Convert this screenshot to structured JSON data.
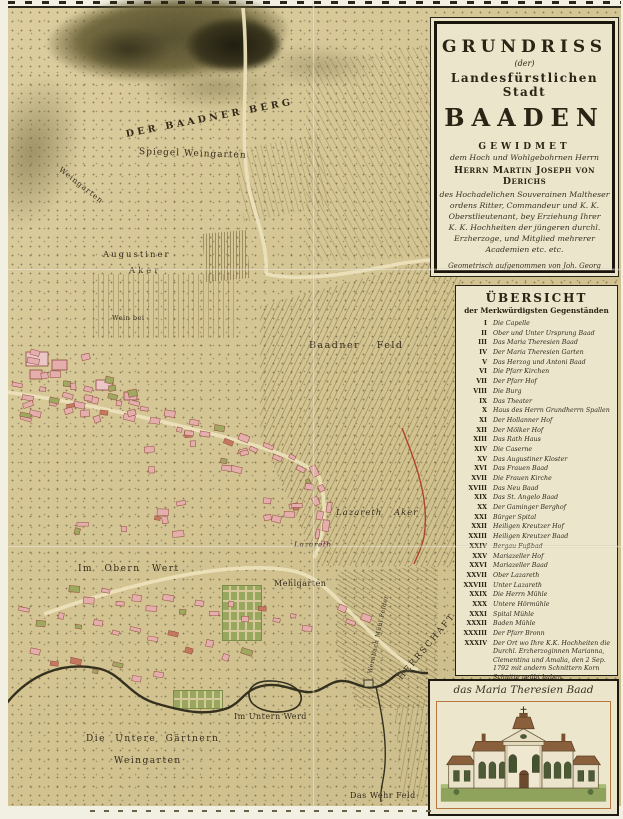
{
  "colors": {
    "paper": "#d5c797",
    "panel_cream": "#ebe5cc",
    "ink": "#2b2414",
    "building_pink": "#e4aeac",
    "garden_green": "#98a75e",
    "river": "#33301e",
    "frame_orange": "#b5773f",
    "boundary_red": "#b0442a"
  },
  "title_panel": {
    "grundriss": "GRUNDRISS",
    "der": "(der)",
    "stadt": "Landesfürstlichen Stadt",
    "baaden": "BAADEN",
    "gewidmet": "GEWIDMET",
    "dedication_intro": "dem Hoch und Wohlgebohrnen Herrn",
    "dedication_name": "Herrn Martin Joseph von Derichs",
    "dedication_lines": [
      "des Hochadelichen Souverainen Maltheser",
      "ordens Ritter, Commandeur und K. K.",
      "Oberstlieutenant, bey Erziehung Ihrer",
      "K. K. Hochheiten der jüngeren durchl.",
      "Erzherzoge, und Mitglied mehrerer",
      "Academien etc. etc."
    ],
    "surveyor_lines": [
      "Geometrisch aufgenommen von Joh. Georg Köller",
      "von einer Hochlöbl. K. K. N. Ö. Landesregierung",
      "zu dieser Aufnahme höchst verordneter Ingenieur"
    ],
    "engraver_line": "Gestochen von Hieronymus Benedicti in Wien 1799"
  },
  "legend": {
    "title": "ÜBERSICHT",
    "subtitle": "der Merkwürdigsten Gegenständen",
    "items": [
      {
        "n": "I",
        "label": "Die Capelle"
      },
      {
        "n": "II",
        "label": "Ober und Unter Ursprung Baad"
      },
      {
        "n": "III",
        "label": "Das Maria Theresien Baad"
      },
      {
        "n": "IV",
        "label": "Der Maria Theresien Garten"
      },
      {
        "n": "V",
        "label": "Das Herzog und Antoni Baad"
      },
      {
        "n": "VI",
        "label": "Die Pfarr Kirchen"
      },
      {
        "n": "VII",
        "label": "Der Pfarr Hof"
      },
      {
        "n": "VIII",
        "label": "Die Burg"
      },
      {
        "n": "IX",
        "label": "Das Theater"
      },
      {
        "n": "X",
        "label": "Haus des Herrn Grundherrn Spallen"
      },
      {
        "n": "XI",
        "label": "Der Hollanner Hof"
      },
      {
        "n": "XII",
        "label": "Der Mölker Hof"
      },
      {
        "n": "XIII",
        "label": "Das Rath Haus"
      },
      {
        "n": "XIV",
        "label": "Die Caserne"
      },
      {
        "n": "XV",
        "label": "Das Augustiner Kloster"
      },
      {
        "n": "XVI",
        "label": "Das Frauen Baad"
      },
      {
        "n": "XVII",
        "label": "Die Frauen Kirche"
      },
      {
        "n": "XVIII",
        "label": "Das Neu Baad"
      },
      {
        "n": "XIX",
        "label": "Das St. Angelo Baad"
      },
      {
        "n": "XX",
        "label": "Der Gaminger Berghof"
      },
      {
        "n": "XXI",
        "label": "Bürger Spital"
      },
      {
        "n": "XXII",
        "label": "Heiligen Kreutzer Hof"
      },
      {
        "n": "XXIII",
        "label": "Heiligen Kreutzer Baad"
      },
      {
        "n": "XXIV",
        "label": "Bergau Fußbad"
      },
      {
        "n": "XXV",
        "label": "Mariazeller Hof"
      },
      {
        "n": "XXVI",
        "label": "Mariazeller Baad"
      },
      {
        "n": "XXVII",
        "label": "Ober Lazareth"
      },
      {
        "n": "XXVIII",
        "label": "Unter Lazareth"
      },
      {
        "n": "XXIX",
        "label": "Die Herrn Mühle"
      },
      {
        "n": "XXX",
        "label": "Untere Hörmühle"
      },
      {
        "n": "XXXI",
        "label": "Spital Mühle"
      },
      {
        "n": "XXXII",
        "label": "Baden Mühle"
      },
      {
        "n": "XXXIII",
        "label": "Der Pfarr Bronn"
      },
      {
        "n": "XXXIV",
        "label": "Der Ort wo Ihre K.K. Hochheiten die Durchl. Erzherzoginnen Marianna, Clementina und Amalia, den 2 Sep. 1792 mit andern Schnittern Korn Schnitte geübt haben."
      }
    ]
  },
  "illustration": {
    "caption": "das Maria Theresien Baad"
  },
  "map": {
    "labels": [
      {
        "text": "DER BAADNER BERG",
        "x": 118,
        "y": 121,
        "rot": -11,
        "fs": 9.5,
        "ls": 3.4,
        "b": 1
      },
      {
        "text": "Spiegel Weingarten",
        "x": 131,
        "y": 139,
        "rot": 2,
        "fs": 9,
        "ls": 1
      },
      {
        "text": "Weingarten",
        "x": 52,
        "y": 156,
        "rot": 38,
        "fs": 7.5,
        "ls": 1
      },
      {
        "text": "Augustiner",
        "x": 95,
        "y": 242,
        "fs": 8.5,
        "ls": 2
      },
      {
        "text": "Aker",
        "x": 121,
        "y": 258,
        "fs": 8.5,
        "ls": 3
      },
      {
        "text": "Wein bei",
        "x": 104,
        "y": 306,
        "fs": 6.5,
        "ls": 0.5
      },
      {
        "text": "Baadner Feld",
        "x": 301,
        "y": 332,
        "fs": 9.5,
        "ls": 1.5,
        "ws": 12
      },
      {
        "text": "Lazareth Aker",
        "x": 328,
        "y": 500,
        "fs": 8.5,
        "ls": 1,
        "it": 1,
        "ws": 8
      },
      {
        "text": "Lazareth",
        "x": 286,
        "y": 532,
        "fs": 7.5,
        "ls": 0.5,
        "it": 1
      },
      {
        "text": "Im Obern Wert",
        "x": 70,
        "y": 556,
        "fs": 9,
        "ls": 1.5,
        "ws": 7
      },
      {
        "text": "Mehlgarten",
        "x": 266,
        "y": 571,
        "fs": 8,
        "ls": 0.5
      },
      {
        "text": "Im Untern Werd",
        "x": 226,
        "y": 704,
        "fs": 8,
        "ls": 0.5
      },
      {
        "text": "Die Untere Gärtnern",
        "x": 78,
        "y": 726,
        "fs": 9,
        "ls": 1.5,
        "ws": 5
      },
      {
        "text": "Weingarten",
        "x": 106,
        "y": 748,
        "fs": 9,
        "ls": 1.5
      },
      {
        "text": "Das Wehr Feld",
        "x": 342,
        "y": 783,
        "fs": 8,
        "ls": 0.5
      },
      {
        "text": "HERRSCHAFT LEESDORF",
        "x": 392,
        "y": 666,
        "rot": -50,
        "fs": 8.5,
        "ls": 2,
        "ws": 6
      },
      {
        "text": "Wernbach Mühl Felder",
        "x": 362,
        "y": 662,
        "rot": -78,
        "fs": 6,
        "ls": 0.5
      }
    ]
  }
}
